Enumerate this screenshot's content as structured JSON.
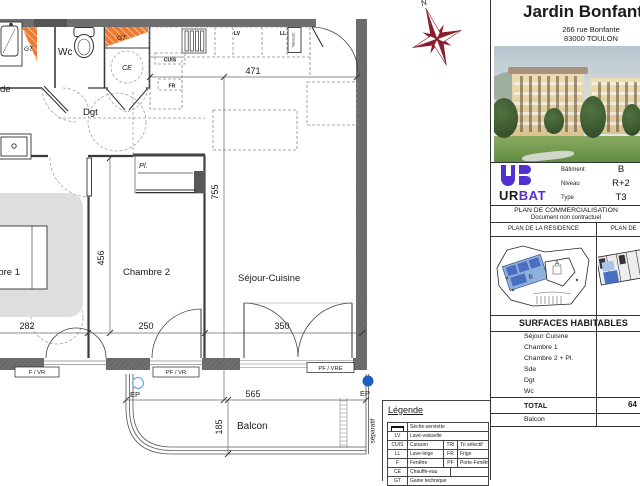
{
  "plan": {
    "compass_label": "N",
    "labels": {
      "sde_partial": "de",
      "wc": "Wc",
      "dgt": "Dgt",
      "ce": "CE",
      "pl": "Pl.",
      "chambre1": "Chambre 1",
      "chambre2": "Chambre 2",
      "sejour_cuisine": "Séjour-Cuisine",
      "balcon": "Balcon",
      "separatif": "séparatif",
      "gt_left": "GT",
      "gt_top": "GT",
      "cuis": "CUIS",
      "fr": "FR",
      "lv": "LV",
      "ll": "LL",
      "tab_elec": "TAB.ELEC",
      "ep_left": "EP",
      "ep_right": "EP"
    },
    "dimensions": {
      "kitchen_width": "471",
      "sejour_height": "755",
      "chambre_height": "456",
      "chambre1_width": "282",
      "chambre2_width": "250",
      "sejour_width": "350",
      "balcon_width": "565",
      "balcon_depth": "185"
    },
    "openings": {
      "window1": "F / VR",
      "window2": "PF / VR",
      "window3": "PF / VRE"
    }
  },
  "legend": {
    "title": "Légende",
    "rows": [
      {
        "abbr": "",
        "name": "Sèche-serviette",
        "abbr2": "",
        "name2": ""
      },
      {
        "abbr": "LV",
        "name": "Lave-vaisselle",
        "abbr2": "",
        "name2": ""
      },
      {
        "abbr": "CUIS",
        "name": "Cuisson",
        "abbr2": "TRI",
        "name2": "Tri sélectif"
      },
      {
        "abbr": "LL",
        "name": "Lave-linge",
        "abbr2": "FR",
        "name2": "Frigo"
      },
      {
        "abbr": "F",
        "name": "Fenêtre",
        "abbr2": "PF",
        "name2": "Porte-Fenêtre"
      },
      {
        "abbr": "CE",
        "name": "Chauffe-eau",
        "abbr2": "",
        "name2": ""
      },
      {
        "abbr": "GT",
        "name": "Gaine technique",
        "abbr2": "",
        "name2": ""
      }
    ]
  },
  "panel": {
    "title": "Jardin Bonfante",
    "address": {
      "line1": "266 rue Bonfante",
      "line2": "83000 TOULON"
    },
    "logo": {
      "ur": "UR",
      "bat": "BAT"
    },
    "info": {
      "batiment_label": "Bâtiment",
      "batiment_value": "B",
      "niveau_label": "Niveau",
      "niveau_value": "R+2",
      "type_label": "Type",
      "type_value": "T3"
    },
    "doc": {
      "line1": "PLAN DE COMMERCIALISATION",
      "line2": "Document non contractuel"
    },
    "headers": {
      "residence": "PLAN DE LA RESIDENCE",
      "etage": "PLAN DE"
    },
    "site": {
      "a": "A.",
      "b": "B"
    },
    "surfaces": {
      "header": "SURFACES HABITABLES",
      "rooms": [
        "Séjour Cuisine",
        "Chambre 1",
        "Chambre 2 + Pl.",
        "Sde",
        "Dgt",
        "Wc"
      ],
      "total_label": "TOTAL",
      "total_value": "64",
      "balcon_label": "Balcon"
    }
  }
}
